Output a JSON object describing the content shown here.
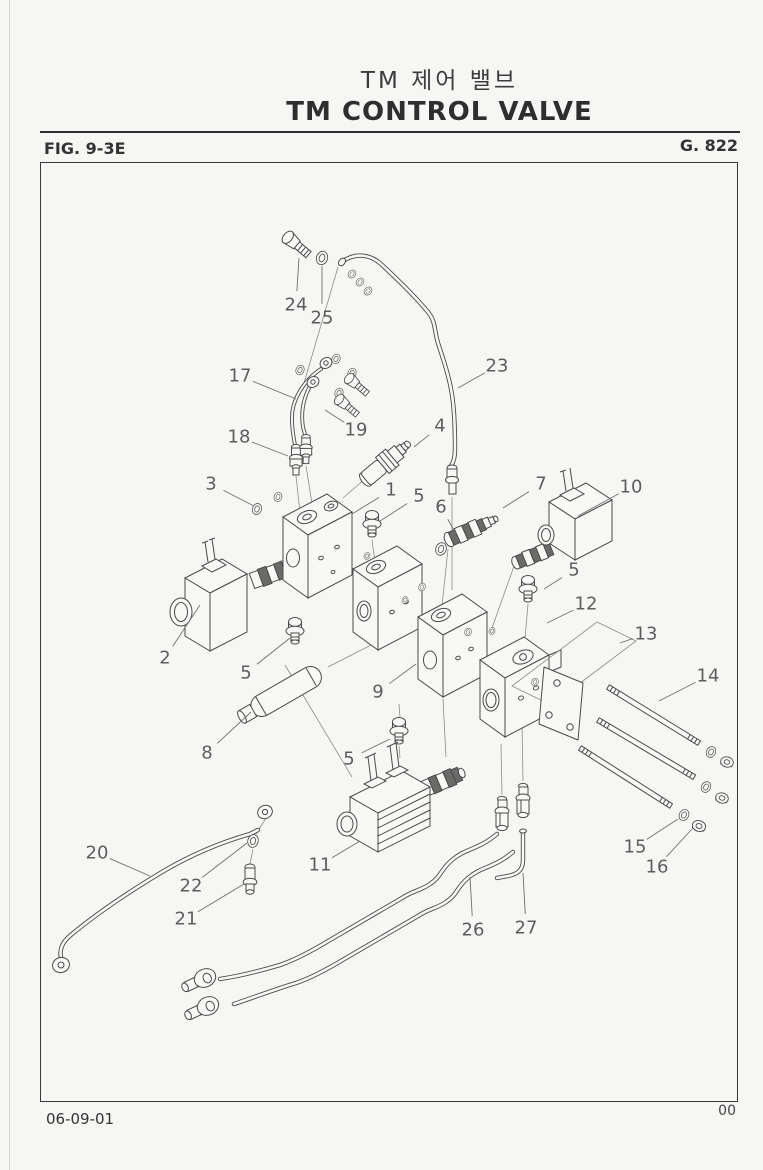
{
  "header": {
    "title_korean": "TM 제어 밸브",
    "title_english": "TM CONTROL VALVE",
    "figure_label": "FIG. 9-3E",
    "group_number": "G. 822"
  },
  "footer": {
    "date": "06-09-01",
    "revision": "00"
  },
  "diagram": {
    "description": "Exploded isometric parts view of the TM control valve assembly with numbered callouts",
    "callouts": [
      {
        "n": "24",
        "x": 296,
        "y": 305,
        "tx": 299,
        "ty": 258
      },
      {
        "n": "25",
        "x": 322,
        "y": 318,
        "tx": 322,
        "ty": 266
      },
      {
        "n": "23",
        "x": 497,
        "y": 366,
        "tx": 458,
        "ty": 388
      },
      {
        "n": "17",
        "x": 240,
        "y": 376,
        "tx": 296,
        "ty": 399
      },
      {
        "n": "19",
        "x": 356,
        "y": 430,
        "tx": 325,
        "ty": 410
      },
      {
        "n": "18",
        "x": 239,
        "y": 437,
        "tx": 288,
        "ty": 456
      },
      {
        "n": "4",
        "x": 440,
        "y": 426,
        "tx": 414,
        "ty": 447
      },
      {
        "n": "3",
        "x": 211,
        "y": 484,
        "tx": 254,
        "ty": 506
      },
      {
        "n": "1",
        "x": 391,
        "y": 490,
        "tx": 352,
        "ty": 514
      },
      {
        "n": "5",
        "x": 419,
        "y": 496,
        "tx": 380,
        "ty": 521
      },
      {
        "n": "7",
        "x": 541,
        "y": 484,
        "tx": 503,
        "ty": 508
      },
      {
        "n": "10",
        "x": 631,
        "y": 487,
        "tx": 578,
        "ty": 516
      },
      {
        "n": "6",
        "x": 441,
        "y": 507,
        "tx": 456,
        "ty": 534
      },
      {
        "n": "5",
        "x": 574,
        "y": 570,
        "tx": 544,
        "ty": 589
      },
      {
        "n": "12",
        "x": 586,
        "y": 604,
        "tx": 547,
        "ty": 623
      },
      {
        "n": "13",
        "x": 646,
        "y": 634,
        "tx": 620,
        "ty": 643
      },
      {
        "n": "2",
        "x": 165,
        "y": 658,
        "tx": 200,
        "ty": 605
      },
      {
        "n": "5",
        "x": 246,
        "y": 673,
        "tx": 290,
        "ty": 638
      },
      {
        "n": "14",
        "x": 708,
        "y": 676,
        "tx": 659,
        "ty": 701
      },
      {
        "n": "9",
        "x": 378,
        "y": 692,
        "tx": 416,
        "ty": 664
      },
      {
        "n": "8",
        "x": 207,
        "y": 753,
        "tx": 251,
        "ty": 712
      },
      {
        "n": "5",
        "x": 349,
        "y": 759,
        "tx": 390,
        "ty": 739
      },
      {
        "n": "15",
        "x": 635,
        "y": 847,
        "tx": 678,
        "ty": 819
      },
      {
        "n": "16",
        "x": 657,
        "y": 867,
        "tx": 692,
        "ty": 829
      },
      {
        "n": "20",
        "x": 97,
        "y": 853,
        "tx": 150,
        "ty": 876
      },
      {
        "n": "11",
        "x": 320,
        "y": 865,
        "tx": 360,
        "ty": 841
      },
      {
        "n": "22",
        "x": 191,
        "y": 886,
        "tx": 247,
        "ty": 843
      },
      {
        "n": "21",
        "x": 186,
        "y": 919,
        "tx": 244,
        "ty": 884
      },
      {
        "n": "26",
        "x": 473,
        "y": 930,
        "tx": 470,
        "ty": 877
      },
      {
        "n": "27",
        "x": 526,
        "y": 928,
        "tx": 523,
        "ty": 873
      }
    ]
  }
}
